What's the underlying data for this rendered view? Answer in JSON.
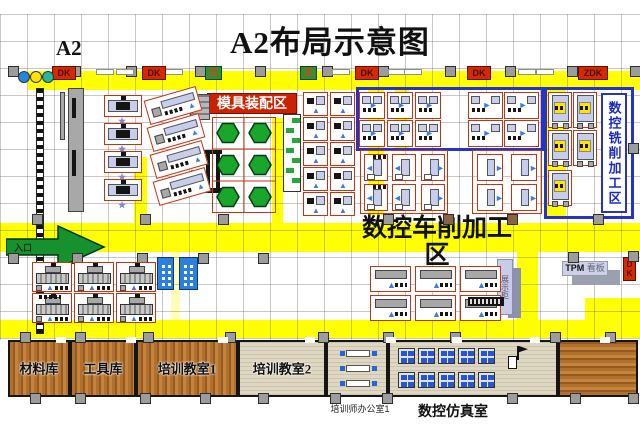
{
  "title": "A2布局示意图",
  "zone_label": "A2",
  "markers": {
    "dk": "DK",
    "zdk": "ZDK",
    "fire": "灭"
  },
  "areas": {
    "mold_assembly": "模具装配区",
    "cnc_milling": "数控铣削加工区",
    "cnc_turning_line1": "数控车削加工",
    "cnc_turning_line2": "区",
    "entrance": "入口",
    "tpm_prefix": "TPM",
    "tpm_suffix": "看板",
    "display_cabinet": "展示柜"
  },
  "rooms": {
    "material": "材料库",
    "tool": "工具库",
    "classroom1": "培训教室1",
    "classroom2": "培训教室2",
    "teacher_office": "培训师办公室1",
    "simulation": "数控仿真室"
  },
  "machines": {
    "press": 4,
    "tilted": 4,
    "station_rows": 5,
    "milling": 5,
    "lathe": 6,
    "computer_clusters": 10,
    "office_desks": 3
  },
  "colors": {
    "corridor": "#ffff00",
    "zone_border": "#2633c6",
    "machine_outline": "#c63310",
    "banner": "#cc2200"
  }
}
